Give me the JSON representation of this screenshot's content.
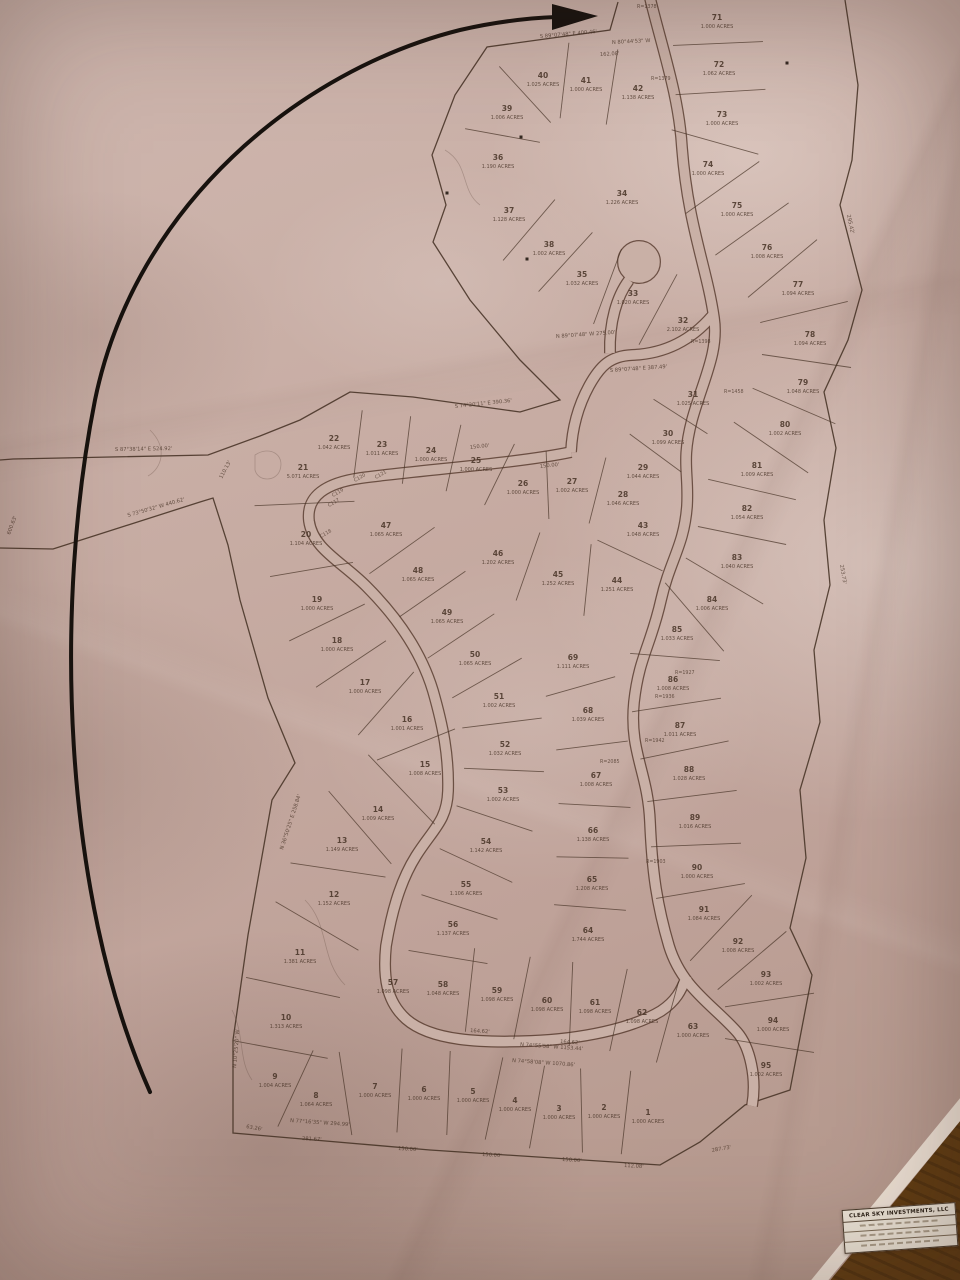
{
  "title_block": {
    "company": "CLEAR SKY INVESTMENTS, LLC"
  },
  "map": {
    "lots": [
      {
        "n": "1",
        "acres": "1.000 ACRES",
        "x": 648,
        "y": 1115
      },
      {
        "n": "2",
        "acres": "1.000 ACRES",
        "x": 604,
        "y": 1110
      },
      {
        "n": "3",
        "acres": "1.000 ACRES",
        "x": 559,
        "y": 1111
      },
      {
        "n": "4",
        "acres": "1.000 ACRES",
        "x": 515,
        "y": 1103
      },
      {
        "n": "5",
        "acres": "1.000 ACRES",
        "x": 473,
        "y": 1094
      },
      {
        "n": "6",
        "acres": "1.000 ACRES",
        "x": 424,
        "y": 1092
      },
      {
        "n": "7",
        "acres": "1.000 ACRES",
        "x": 375,
        "y": 1089
      },
      {
        "n": "8",
        "acres": "1.064 ACRES",
        "x": 316,
        "y": 1098
      },
      {
        "n": "9",
        "acres": "1.004 ACRES",
        "x": 275,
        "y": 1079
      },
      {
        "n": "10",
        "acres": "1.313 ACRES",
        "x": 286,
        "y": 1020
      },
      {
        "n": "11",
        "acres": "1.381 ACRES",
        "x": 300,
        "y": 955
      },
      {
        "n": "12",
        "acres": "1.152 ACRES",
        "x": 334,
        "y": 897
      },
      {
        "n": "13",
        "acres": "1.149 ACRES",
        "x": 342,
        "y": 843
      },
      {
        "n": "14",
        "acres": "1.009 ACRES",
        "x": 378,
        "y": 812
      },
      {
        "n": "15",
        "acres": "1.008 ACRES",
        "x": 425,
        "y": 767
      },
      {
        "n": "16",
        "acres": "1.001 ACRES",
        "x": 407,
        "y": 722
      },
      {
        "n": "17",
        "acres": "1.000 ACRES",
        "x": 365,
        "y": 685
      },
      {
        "n": "18",
        "acres": "1.000 ACRES",
        "x": 337,
        "y": 643
      },
      {
        "n": "19",
        "acres": "1.000 ACRES",
        "x": 317,
        "y": 602
      },
      {
        "n": "20",
        "acres": "1.104 ACRES",
        "x": 306,
        "y": 537
      },
      {
        "n": "21",
        "acres": "5.071 ACRES",
        "x": 303,
        "y": 470
      },
      {
        "n": "22",
        "acres": "1.042 ACRES",
        "x": 334,
        "y": 441
      },
      {
        "n": "23",
        "acres": "1.011 ACRES",
        "x": 382,
        "y": 447
      },
      {
        "n": "24",
        "acres": "1.000 ACRES",
        "x": 431,
        "y": 453
      },
      {
        "n": "25",
        "acres": "1.000 ACRES",
        "x": 476,
        "y": 463
      },
      {
        "n": "26",
        "acres": "1.000 ACRES",
        "x": 523,
        "y": 486
      },
      {
        "n": "27",
        "acres": "1.002 ACRES",
        "x": 572,
        "y": 484
      },
      {
        "n": "28",
        "acres": "1.046 ACRES",
        "x": 623,
        "y": 497
      },
      {
        "n": "29",
        "acres": "1.044 ACRES",
        "x": 643,
        "y": 470
      },
      {
        "n": "30",
        "acres": "1.099 ACRES",
        "x": 668,
        "y": 436
      },
      {
        "n": "31",
        "acres": "1.025 ACRES",
        "x": 693,
        "y": 397
      },
      {
        "n": "32",
        "acres": "2.102 ACRES",
        "x": 683,
        "y": 323
      },
      {
        "n": "33",
        "acres": "1.020 ACRES",
        "x": 633,
        "y": 296
      },
      {
        "n": "34",
        "acres": "1.226 ACRES",
        "x": 622,
        "y": 196
      },
      {
        "n": "35",
        "acres": "1.032 ACRES",
        "x": 582,
        "y": 277
      },
      {
        "n": "36",
        "acres": "1.190 ACRES",
        "x": 498,
        "y": 160
      },
      {
        "n": "37",
        "acres": "1.128 ACRES",
        "x": 509,
        "y": 213
      },
      {
        "n": "38",
        "acres": "1.002 ACRES",
        "x": 549,
        "y": 247
      },
      {
        "n": "39",
        "acres": "1.006 ACRES",
        "x": 507,
        "y": 111
      },
      {
        "n": "40",
        "acres": "1.025 ACRES",
        "x": 543,
        "y": 78
      },
      {
        "n": "41",
        "acres": "1.000 ACRES",
        "x": 586,
        "y": 83
      },
      {
        "n": "42",
        "acres": "1.138 ACRES",
        "x": 638,
        "y": 91
      },
      {
        "n": "43",
        "acres": "1.048 ACRES",
        "x": 643,
        "y": 528
      },
      {
        "n": "44",
        "acres": "1.251 ACRES",
        "x": 617,
        "y": 583
      },
      {
        "n": "45",
        "acres": "1.252 ACRES",
        "x": 558,
        "y": 577
      },
      {
        "n": "46",
        "acres": "1.202 ACRES",
        "x": 498,
        "y": 556
      },
      {
        "n": "47",
        "acres": "1.065 ACRES",
        "x": 386,
        "y": 528
      },
      {
        "n": "48",
        "acres": "1.065 ACRES",
        "x": 418,
        "y": 573
      },
      {
        "n": "49",
        "acres": "1.065 ACRES",
        "x": 447,
        "y": 615
      },
      {
        "n": "50",
        "acres": "1.065 ACRES",
        "x": 475,
        "y": 657
      },
      {
        "n": "51",
        "acres": "1.002 ACRES",
        "x": 499,
        "y": 699
      },
      {
        "n": "52",
        "acres": "1.032 ACRES",
        "x": 505,
        "y": 747
      },
      {
        "n": "53",
        "acres": "1.002 ACRES",
        "x": 503,
        "y": 793
      },
      {
        "n": "54",
        "acres": "1.142 ACRES",
        "x": 486,
        "y": 844
      },
      {
        "n": "55",
        "acres": "1.106 ACRES",
        "x": 466,
        "y": 887
      },
      {
        "n": "56",
        "acres": "1.137 ACRES",
        "x": 453,
        "y": 927
      },
      {
        "n": "57",
        "acres": "1.098 ACRES",
        "x": 393,
        "y": 985
      },
      {
        "n": "58",
        "acres": "1.048 ACRES",
        "x": 443,
        "y": 987
      },
      {
        "n": "59",
        "acres": "1.098 ACRES",
        "x": 497,
        "y": 993
      },
      {
        "n": "60",
        "acres": "1.098 ACRES",
        "x": 547,
        "y": 1003
      },
      {
        "n": "61",
        "acres": "1.098 ACRES",
        "x": 595,
        "y": 1005
      },
      {
        "n": "62",
        "acres": "1.098 ACRES",
        "x": 642,
        "y": 1015
      },
      {
        "n": "63",
        "acres": "1.000 ACRES",
        "x": 693,
        "y": 1029
      },
      {
        "n": "64",
        "acres": "1.744 ACRES",
        "x": 588,
        "y": 933
      },
      {
        "n": "65",
        "acres": "1.208 ACRES",
        "x": 592,
        "y": 882
      },
      {
        "n": "66",
        "acres": "1.138 ACRES",
        "x": 593,
        "y": 833
      },
      {
        "n": "67",
        "acres": "1.008 ACRES",
        "x": 596,
        "y": 778
      },
      {
        "n": "68",
        "acres": "1.039 ACRES",
        "x": 588,
        "y": 713
      },
      {
        "n": "69",
        "acres": "1.111 ACRES",
        "x": 573,
        "y": 660
      },
      {
        "n": "71",
        "acres": "1.000 ACRES",
        "x": 717,
        "y": 20
      },
      {
        "n": "72",
        "acres": "1.062 ACRES",
        "x": 719,
        "y": 67
      },
      {
        "n": "73",
        "acres": "1.000 ACRES",
        "x": 722,
        "y": 117
      },
      {
        "n": "74",
        "acres": "1.000 ACRES",
        "x": 708,
        "y": 167
      },
      {
        "n": "75",
        "acres": "1.000 ACRES",
        "x": 737,
        "y": 208
      },
      {
        "n": "76",
        "acres": "1.008 ACRES",
        "x": 767,
        "y": 250
      },
      {
        "n": "77",
        "acres": "1.094 ACRES",
        "x": 798,
        "y": 287
      },
      {
        "n": "78",
        "acres": "1.094 ACRES",
        "x": 810,
        "y": 337
      },
      {
        "n": "79",
        "acres": "1.048 ACRES",
        "x": 803,
        "y": 385
      },
      {
        "n": "80",
        "acres": "1.002 ACRES",
        "x": 785,
        "y": 427
      },
      {
        "n": "81",
        "acres": "1.009 ACRES",
        "x": 757,
        "y": 468
      },
      {
        "n": "82",
        "acres": "1.054 ACRES",
        "x": 747,
        "y": 511
      },
      {
        "n": "83",
        "acres": "1.040 ACRES",
        "x": 737,
        "y": 560
      },
      {
        "n": "84",
        "acres": "1.006 ACRES",
        "x": 712,
        "y": 602
      },
      {
        "n": "85",
        "acres": "1.033 ACRES",
        "x": 677,
        "y": 632
      },
      {
        "n": "86",
        "acres": "1.008 ACRES",
        "x": 673,
        "y": 682
      },
      {
        "n": "87",
        "acres": "1.011 ACRES",
        "x": 680,
        "y": 728
      },
      {
        "n": "88",
        "acres": "1.028 ACRES",
        "x": 689,
        "y": 772
      },
      {
        "n": "89",
        "acres": "1.016 ACRES",
        "x": 695,
        "y": 820
      },
      {
        "n": "90",
        "acres": "1.000 ACRES",
        "x": 697,
        "y": 870
      },
      {
        "n": "91",
        "acres": "1.084 ACRES",
        "x": 704,
        "y": 912
      },
      {
        "n": "92",
        "acres": "1.008 ACRES",
        "x": 738,
        "y": 944
      },
      {
        "n": "93",
        "acres": "1.002 ACRES",
        "x": 766,
        "y": 977
      },
      {
        "n": "94",
        "acres": "1.000 ACRES",
        "x": 773,
        "y": 1023
      },
      {
        "n": "95",
        "acres": "1.002 ACRES",
        "x": 766,
        "y": 1068
      }
    ],
    "bands": [
      {
        "ids": [
          "22",
          "23",
          "24",
          "25",
          "26",
          "27",
          "28"
        ],
        "half": 34
      },
      {
        "ids": [
          "21",
          "20"
        ],
        "half": 50
      },
      {
        "ids": [
          "20",
          "19",
          "18",
          "17",
          "16",
          "15"
        ],
        "half": 42
      },
      {
        "ids": [
          "15",
          "14",
          "13",
          "12",
          "11",
          "10"
        ],
        "half": 48
      },
      {
        "ids": [
          "10",
          "9"
        ],
        "half": 48
      },
      {
        "ids": [
          "9",
          "8",
          "7",
          "6",
          "5",
          "4",
          "3",
          "2",
          "1"
        ],
        "half": 42
      },
      {
        "ids": [
          "47",
          "48",
          "49",
          "50",
          "51",
          "52",
          "53",
          "54",
          "55",
          "56",
          "58"
        ],
        "half": 40
      },
      {
        "ids": [
          "58",
          "59",
          "60",
          "61",
          "62",
          "63"
        ],
        "half": 42
      },
      {
        "ids": [
          "46",
          "45",
          "44",
          "43"
        ],
        "half": 36
      },
      {
        "ids": [
          "37",
          "38",
          "35",
          "33",
          "32"
        ],
        "half": 40
      },
      {
        "ids": [
          "36",
          "39",
          "40",
          "41",
          "42"
        ],
        "half": 38
      },
      {
        "ids": [
          "31",
          "30",
          "29"
        ],
        "half": 32
      },
      {
        "ids": [
          "69",
          "68",
          "67",
          "66",
          "65",
          "64"
        ],
        "half": 36
      },
      {
        "ids": [
          "71",
          "72",
          "73",
          "74",
          "75",
          "76",
          "77",
          "78",
          "79",
          "80",
          "81",
          "82",
          "83",
          "84",
          "85",
          "86",
          "87",
          "88",
          "89",
          "90",
          "91",
          "92",
          "93",
          "94",
          "95"
        ],
        "half": 45
      }
    ],
    "annotations": [
      {
        "text": "S 89°07'48\" E  400.46'",
        "x": 540,
        "y": 38,
        "rot": -5
      },
      {
        "text": "N 80°44'53\" W",
        "x": 612,
        "y": 44,
        "rot": -3
      },
      {
        "text": "162.08'",
        "x": 600,
        "y": 56,
        "rot": -3
      },
      {
        "text": "S 87°38'14\" E  524.92'",
        "x": 115,
        "y": 451,
        "rot": -1
      },
      {
        "text": "S 73°50'32\" W  440.62'",
        "x": 128,
        "y": 517,
        "rot": -16
      },
      {
        "text": "110.13'",
        "x": 222,
        "y": 479,
        "rot": -62
      },
      {
        "text": "600.63'",
        "x": 10,
        "y": 535,
        "rot": -70
      },
      {
        "text": "S 74°20'11\" E  390.36'",
        "x": 455,
        "y": 408,
        "rot": -6
      },
      {
        "text": "N 89°07'48\" W  275.00'",
        "x": 556,
        "y": 338,
        "rot": -4
      },
      {
        "text": "S 89°07'48\" E  387.49'",
        "x": 610,
        "y": 372,
        "rot": -4
      },
      {
        "text": "N 74°55'58\" W  1153.44'",
        "x": 520,
        "y": 1046,
        "rot": 4
      },
      {
        "text": "N 74°58'08\" W  1070.86'",
        "x": 512,
        "y": 1062,
        "rot": 4
      },
      {
        "text": "N 77°16'35\" W  294.99'",
        "x": 290,
        "y": 1122,
        "rot": 4
      },
      {
        "text": "281.67'",
        "x": 302,
        "y": 1140,
        "rot": 3
      },
      {
        "text": "150.00'",
        "x": 398,
        "y": 1150,
        "rot": 3
      },
      {
        "text": "150.00'",
        "x": 482,
        "y": 1156,
        "rot": 3
      },
      {
        "text": "150.00'",
        "x": 562,
        "y": 1161,
        "rot": 3
      },
      {
        "text": "112.08'",
        "x": 624,
        "y": 1167,
        "rot": 3
      },
      {
        "text": "287.73'",
        "x": 712,
        "y": 1152,
        "rot": -10
      },
      {
        "text": "150.00'",
        "x": 470,
        "y": 449,
        "rot": -6
      },
      {
        "text": "150.00'",
        "x": 540,
        "y": 468,
        "rot": -6
      },
      {
        "text": "164.62'",
        "x": 470,
        "y": 1032,
        "rot": 4
      },
      {
        "text": "164.62'",
        "x": 560,
        "y": 1043,
        "rot": 4
      },
      {
        "text": "N 10°25'20\" W",
        "x": 236,
        "y": 1068,
        "rot": -85
      },
      {
        "text": "63.26'",
        "x": 246,
        "y": 1128,
        "rot": 10
      },
      {
        "text": "295.42'",
        "x": 847,
        "y": 215,
        "rot": 78
      },
      {
        "text": "253.73'",
        "x": 840,
        "y": 565,
        "rot": 80
      },
      {
        "text": "N 36°50'25\" E  258.84'",
        "x": 283,
        "y": 850,
        "rot": -72
      }
    ],
    "radius_labels": [
      {
        "text": "R=1378",
        "x": 637,
        "y": 8
      },
      {
        "text": "R=1379",
        "x": 651,
        "y": 80
      },
      {
        "text": "R=1398",
        "x": 691,
        "y": 343
      },
      {
        "text": "R=1458",
        "x": 724,
        "y": 393
      },
      {
        "text": "R=1927",
        "x": 675,
        "y": 674
      },
      {
        "text": "R=1936",
        "x": 655,
        "y": 698
      },
      {
        "text": "R=1942",
        "x": 645,
        "y": 742
      },
      {
        "text": "R=2085",
        "x": 600,
        "y": 763
      },
      {
        "text": "R=1903",
        "x": 646,
        "y": 863
      }
    ],
    "curve_labels": [
      {
        "text": "C117",
        "x": 329,
        "y": 507
      },
      {
        "text": "C118",
        "x": 321,
        "y": 538
      },
      {
        "text": "C119",
        "x": 333,
        "y": 497
      },
      {
        "text": "C120",
        "x": 355,
        "y": 482
      },
      {
        "text": "C121",
        "x": 376,
        "y": 479
      }
    ],
    "dots": [
      {
        "x": 527,
        "y": 259
      },
      {
        "x": 521,
        "y": 137
      },
      {
        "x": 787,
        "y": 63
      },
      {
        "x": 447,
        "y": 193
      }
    ]
  },
  "colors": {
    "ink": "#473326",
    "paper_road": "#c9b0a6",
    "arrow": "#17120e"
  }
}
